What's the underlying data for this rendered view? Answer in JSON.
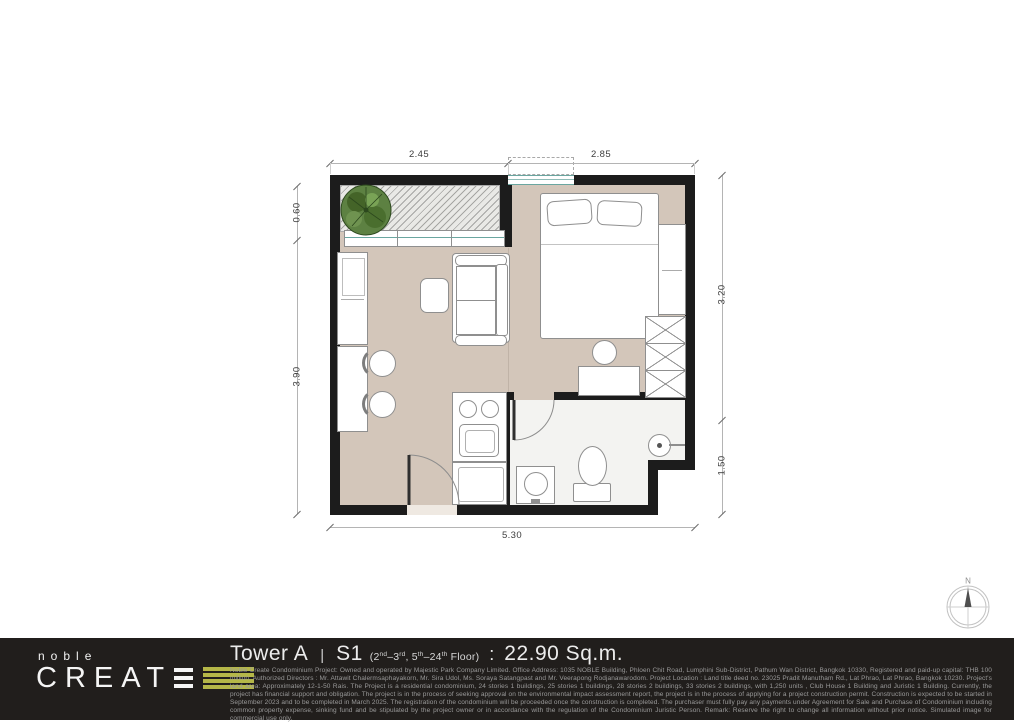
{
  "plan": {
    "unit_outline": "studio unit S1",
    "dimensions": {
      "top": [
        "2.45",
        "2.85"
      ],
      "left": [
        "0.60",
        "3.90"
      ],
      "right": [
        "3.20",
        "1.50"
      ],
      "bottom": [
        "5.30"
      ]
    },
    "compass_label": "N",
    "rooms": [
      "balcony",
      "sleeping-area",
      "living-area",
      "kitchenette",
      "bathroom"
    ],
    "icons": {
      "tree": "plant-top-view-icon",
      "compass": "compass-north-icon",
      "door_swings": "quarter-circle-door-arc"
    },
    "colors": {
      "wall": "#1c1c1c",
      "floor": "#d3c6ba",
      "bathroom_floor": "#f3f3f1",
      "window_teal": "#6aa6a0"
    }
  },
  "footer": {
    "brand": {
      "name_top": "noble",
      "name_main": "CREAT"
    },
    "title": {
      "tower": "Tower A",
      "separator": "|",
      "unit_type": "S1",
      "floor_range": [
        "(2",
        "nd",
        "–3",
        "rd",
        ", 5",
        "th",
        "–24",
        "th",
        " Floor)"
      ],
      "colon": ":",
      "area": "22.90 Sq.m."
    },
    "disclaimer": "Noble Create Condominium Project: Owned and operated by Majestic Park Company Limited. Office Address: 1035 NOBLE Building, Phloen Chit Road, Lumphini Sub-District, Pathum Wan District, Bangkok 10330, Registered and paid-up capital: THB 100 million. Authorized Directors : Mr. Attawit Chalermsaphayakorn, Mr. Sira Udol, Ms. Soraya Satangpast and Mr. Veerapong Rodjanawarodom. Project Location : Land title deed no. 23025 Pradit Manutham Rd., Lat Phrao, Lat Phrao, Bangkok 10230. Project's land area: Approximately 12-1-50 Rais. The Project is a residential condominium, 24 stories 1 buildings, 25 stories 1 buildings, 28 stories 2 buildings, 33 stories 2 buildings, with 1,250 units , Club House 1 Building and Juristic 1 Building. Currently, the project has financial support and obligation. The project is in the process of seeking approval on the environmental impact assessment report, the project is in the process of applying for a project construction permit. Construction is expected to be started in September 2023 and to be completed in March 2025. The registration of the condominium will be proceeded once the construction is completed. The purchaser must fully pay any payments under Agreement for Sale and Purchase of Condominium including common property expense, sinking fund and be stipulated by the project owner or in accordance with the regulation of the Condominium Juristic Person. Remark: Reserve the right to change all information without prior notice. Simulated image for commercial use only.",
    "colors": {
      "accent_bars": "#b5b748",
      "footer_bg": "#211e1c"
    }
  }
}
